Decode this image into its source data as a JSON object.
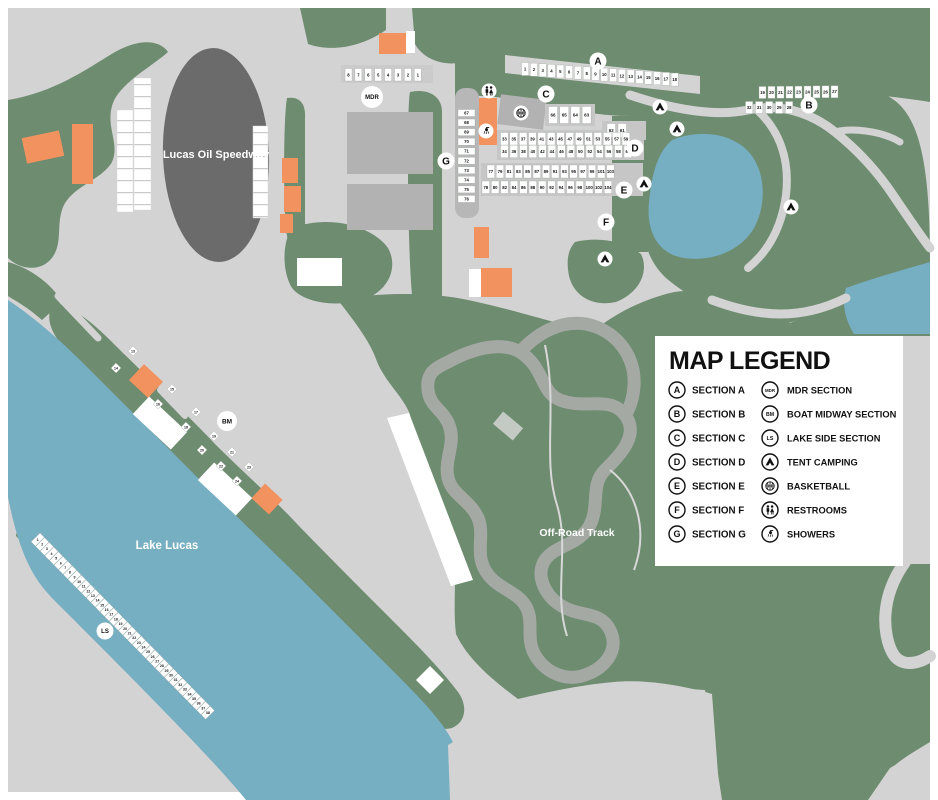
{
  "map": {
    "speedway_label": "Lucas Oil Speedway",
    "lake_label": "Lake Lucas",
    "offroad_label": "Off-Road Track"
  },
  "colors": {
    "background_gray": "#d3d3d3",
    "grass_green": "#6e8c70",
    "water_blue": "#76aec2",
    "speedway_dark": "#6b6b6b",
    "building_gray": "#b2b2b2",
    "building_orange": "#f2935f",
    "track_gray": "#a4a9a4",
    "lot_white": "#ffffff"
  },
  "legend": {
    "title": "MAP LEGEND",
    "left": [
      {
        "badge": "A",
        "label": "SECTION A"
      },
      {
        "badge": "B",
        "label": "SECTION B"
      },
      {
        "badge": "C",
        "label": "SECTION C"
      },
      {
        "badge": "D",
        "label": "SECTION D"
      },
      {
        "badge": "E",
        "label": "SECTION E"
      },
      {
        "badge": "F",
        "label": "SECTION F"
      },
      {
        "badge": "G",
        "label": "SECTION G"
      }
    ],
    "right": [
      {
        "badge": "MDR",
        "label": "MDR SECTION"
      },
      {
        "badge": "BM",
        "label": "BOAT MIDWAY SECTION"
      },
      {
        "badge": "LS",
        "label": "LAKE SIDE SECTION"
      },
      {
        "icon": "tent",
        "label": "TENT CAMPING"
      },
      {
        "icon": "basketball",
        "label": "BASKETBALL"
      },
      {
        "icon": "restrooms",
        "label": "RESTROOMS"
      },
      {
        "icon": "showers",
        "label": "SHOWERS"
      }
    ]
  },
  "badges": [
    {
      "label": "A",
      "x": 598,
      "y": 61,
      "r": 8.5,
      "fs": 10
    },
    {
      "label": "B",
      "x": 809,
      "y": 105,
      "r": 8.5,
      "fs": 10
    },
    {
      "label": "C",
      "x": 546,
      "y": 94,
      "r": 8.5,
      "fs": 10
    },
    {
      "label": "D",
      "x": 635,
      "y": 148,
      "r": 8.5,
      "fs": 10
    },
    {
      "label": "E",
      "x": 624,
      "y": 190,
      "r": 8.5,
      "fs": 10
    },
    {
      "label": "F",
      "x": 606,
      "y": 222,
      "r": 8.5,
      "fs": 10
    },
    {
      "label": "G",
      "x": 446,
      "y": 161,
      "r": 8.5,
      "fs": 10
    },
    {
      "label": "MDR",
      "x": 372,
      "y": 97,
      "r": 11,
      "fs": 6
    },
    {
      "label": "BM",
      "x": 227,
      "y": 421,
      "r": 10,
      "fs": 6.5
    },
    {
      "label": "LS",
      "x": 105,
      "y": 631,
      "r": 8.5,
      "fs": 6
    }
  ],
  "map_icons": [
    {
      "icon": "tent",
      "x": 660,
      "y": 107
    },
    {
      "icon": "tent",
      "x": 677,
      "y": 129
    },
    {
      "icon": "tent",
      "x": 644,
      "y": 184
    },
    {
      "icon": "tent",
      "x": 791,
      "y": 207
    },
    {
      "icon": "tent",
      "x": 605,
      "y": 259
    },
    {
      "icon": "basketball",
      "x": 521,
      "y": 113
    },
    {
      "icon": "restrooms",
      "x": 489,
      "y": 91
    },
    {
      "icon": "showers",
      "x": 486,
      "y": 131
    }
  ],
  "lot_rows": [
    {
      "name": "section-a",
      "x": 521.5,
      "y": 62.5,
      "dx": 8.8,
      "dy": 0.62,
      "w": 7.2,
      "h": 13,
      "fs": 4.3,
      "numbers": [
        "1",
        "2",
        "3",
        "4",
        "5",
        "6",
        "7",
        "8",
        "9",
        "10",
        "11",
        "12",
        "13",
        "14",
        "15",
        "16",
        "17",
        "18"
      ]
    },
    {
      "name": "mdr-row",
      "x": 345,
      "y": 68.5,
      "dx": 9.9,
      "dy": 0,
      "w": 7,
      "h": 12.5,
      "fs": 4.3,
      "numbers": [
        "8",
        "7",
        "6",
        "5",
        "4",
        "3",
        "2",
        "1"
      ]
    },
    {
      "name": "section-b-north",
      "x": 759,
      "y": 86.5,
      "dx": 9,
      "dy": -0.1,
      "w": 7,
      "h": 12,
      "fs": 4.3,
      "numbers": [
        "19",
        "20",
        "21",
        "22",
        "23",
        "24",
        "25",
        "26",
        "27"
      ]
    },
    {
      "name": "section-b-south",
      "x": 745.5,
      "y": 101.5,
      "dx": 10,
      "dy": 0,
      "w": 7.2,
      "h": 12,
      "fs": 4.3,
      "numbers": [
        "32",
        "31",
        "30",
        "29",
        "28"
      ]
    },
    {
      "name": "section-c-row",
      "x": 548.5,
      "y": 106.5,
      "dx": 11.2,
      "dy": 0,
      "w": 9,
      "h": 17,
      "fs": 4.5,
      "numbers": [
        "66",
        "65",
        "64",
        "63"
      ]
    },
    {
      "name": "row-62-61",
      "x": 607,
      "y": 123.5,
      "dx": 11,
      "dy": 0,
      "w": 8.5,
      "h": 14,
      "fs": 4.4,
      "numbers": [
        "62",
        "61"
      ]
    },
    {
      "name": "section-d-north",
      "x": 500.5,
      "y": 132.5,
      "dx": 9.35,
      "dy": 0,
      "w": 7.8,
      "h": 12.5,
      "fs": 4.3,
      "numbers": [
        "33",
        "35",
        "37",
        "39",
        "41",
        "43",
        "45",
        "47",
        "49",
        "51",
        "53",
        "55",
        "57",
        "59"
      ]
    },
    {
      "name": "section-d-south",
      "x": 500.5,
      "y": 145.2,
      "dx": 9.5,
      "dy": 0,
      "w": 7.8,
      "h": 12.5,
      "fs": 4.3,
      "numbers": [
        "34",
        "36",
        "38",
        "40",
        "42",
        "44",
        "46",
        "48",
        "50",
        "52",
        "54",
        "56",
        "58",
        "60"
      ]
    },
    {
      "name": "section-e-north",
      "x": 487,
      "y": 165,
      "dx": 9.2,
      "dy": 0,
      "w": 7.6,
      "h": 13,
      "fs": 4.3,
      "numbers": [
        "77",
        "79",
        "81",
        "83",
        "85",
        "87",
        "89",
        "91",
        "93",
        "95",
        "97",
        "99",
        "101",
        "103"
      ]
    },
    {
      "name": "section-e-south",
      "x": 482,
      "y": 181,
      "dx": 9.4,
      "dy": 0,
      "w": 7.6,
      "h": 12.5,
      "fs": 4.3,
      "numbers": [
        "78",
        "80",
        "82",
        "84",
        "86",
        "88",
        "90",
        "92",
        "94",
        "96",
        "98",
        "100",
        "102",
        "104"
      ]
    },
    {
      "name": "section-g-column",
      "x": 458,
      "y": 109.5,
      "dx": 0,
      "dy": 9.55,
      "w": 17,
      "h": 7,
      "fs": 4.3,
      "numbers": [
        "67",
        "68",
        "69",
        "70",
        "71",
        "72",
        "73",
        "74",
        "75",
        "76"
      ]
    },
    {
      "name": "lake-side-strip",
      "x": 40,
      "y": 533,
      "dx": 6.56,
      "dy": 0,
      "w": 6.2,
      "h": 12.5,
      "fs": 3.6,
      "rot": 45.5,
      "upright": true,
      "numbers": [
        "1",
        "2",
        "3",
        "4",
        "5",
        "6",
        "7",
        "8",
        "9",
        "10",
        "11",
        "12",
        "13",
        "14",
        "15",
        "16",
        "17",
        "18",
        "19",
        "20",
        "21",
        "22",
        "23",
        "24",
        "25",
        "26",
        "27",
        "28",
        "29",
        "30",
        "31",
        "32",
        "33",
        "34",
        "35",
        "36",
        "37",
        "38"
      ]
    },
    {
      "name": "boat-midway-lots",
      "rot": 43,
      "w": 7,
      "h": 7,
      "fs": 3.5,
      "upright": true,
      "cells": [
        [
          133,
          351
        ],
        [
          116,
          368
        ],
        [
          172,
          389
        ],
        [
          158,
          404
        ],
        [
          196,
          412
        ],
        [
          186,
          427
        ],
        [
          214,
          436
        ],
        [
          202,
          450
        ],
        [
          232,
          452
        ],
        [
          221,
          466
        ],
        [
          249,
          467
        ],
        [
          237,
          481
        ]
      ],
      "numbers": [
        "13",
        "14",
        "15",
        "16",
        "17",
        "18",
        "19",
        "20",
        "21",
        "22",
        "23",
        "24"
      ]
    }
  ]
}
